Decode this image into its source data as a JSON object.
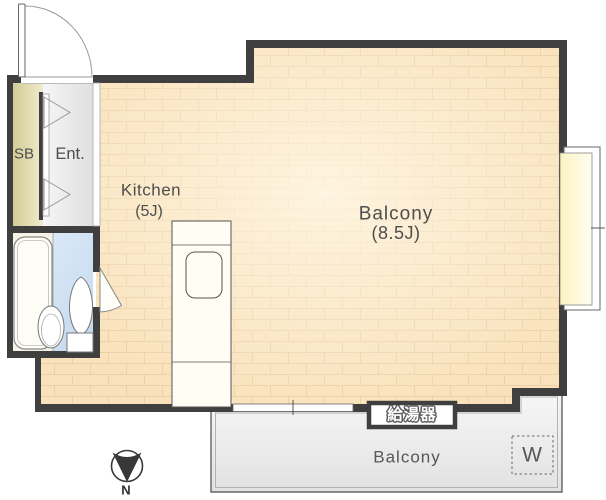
{
  "colors": {
    "wall": "#3f3f3f",
    "floor": "#f9e2bb",
    "floor_line": "#eccfa4",
    "floor_glow": "#fff7e6",
    "balcony": "#ececec",
    "bath": "#cfe0f2",
    "bath_cream": "#f5f2e6",
    "sb": "#d8d1a2",
    "ent": "#ebebeb",
    "window_glass": "#fcf7cf",
    "text": "#4e4e4e"
  },
  "rooms": {
    "shoe_box": "SB",
    "entrance": "Ent.",
    "kitchen_name": "Kitchen",
    "kitchen_size": "(5J)",
    "main_room_name": "Balcony",
    "main_room_size": "(8.5J)",
    "balcony": "Balcony",
    "washer": "W",
    "water_heater": "給湯器"
  },
  "compass": {
    "north": "N"
  }
}
